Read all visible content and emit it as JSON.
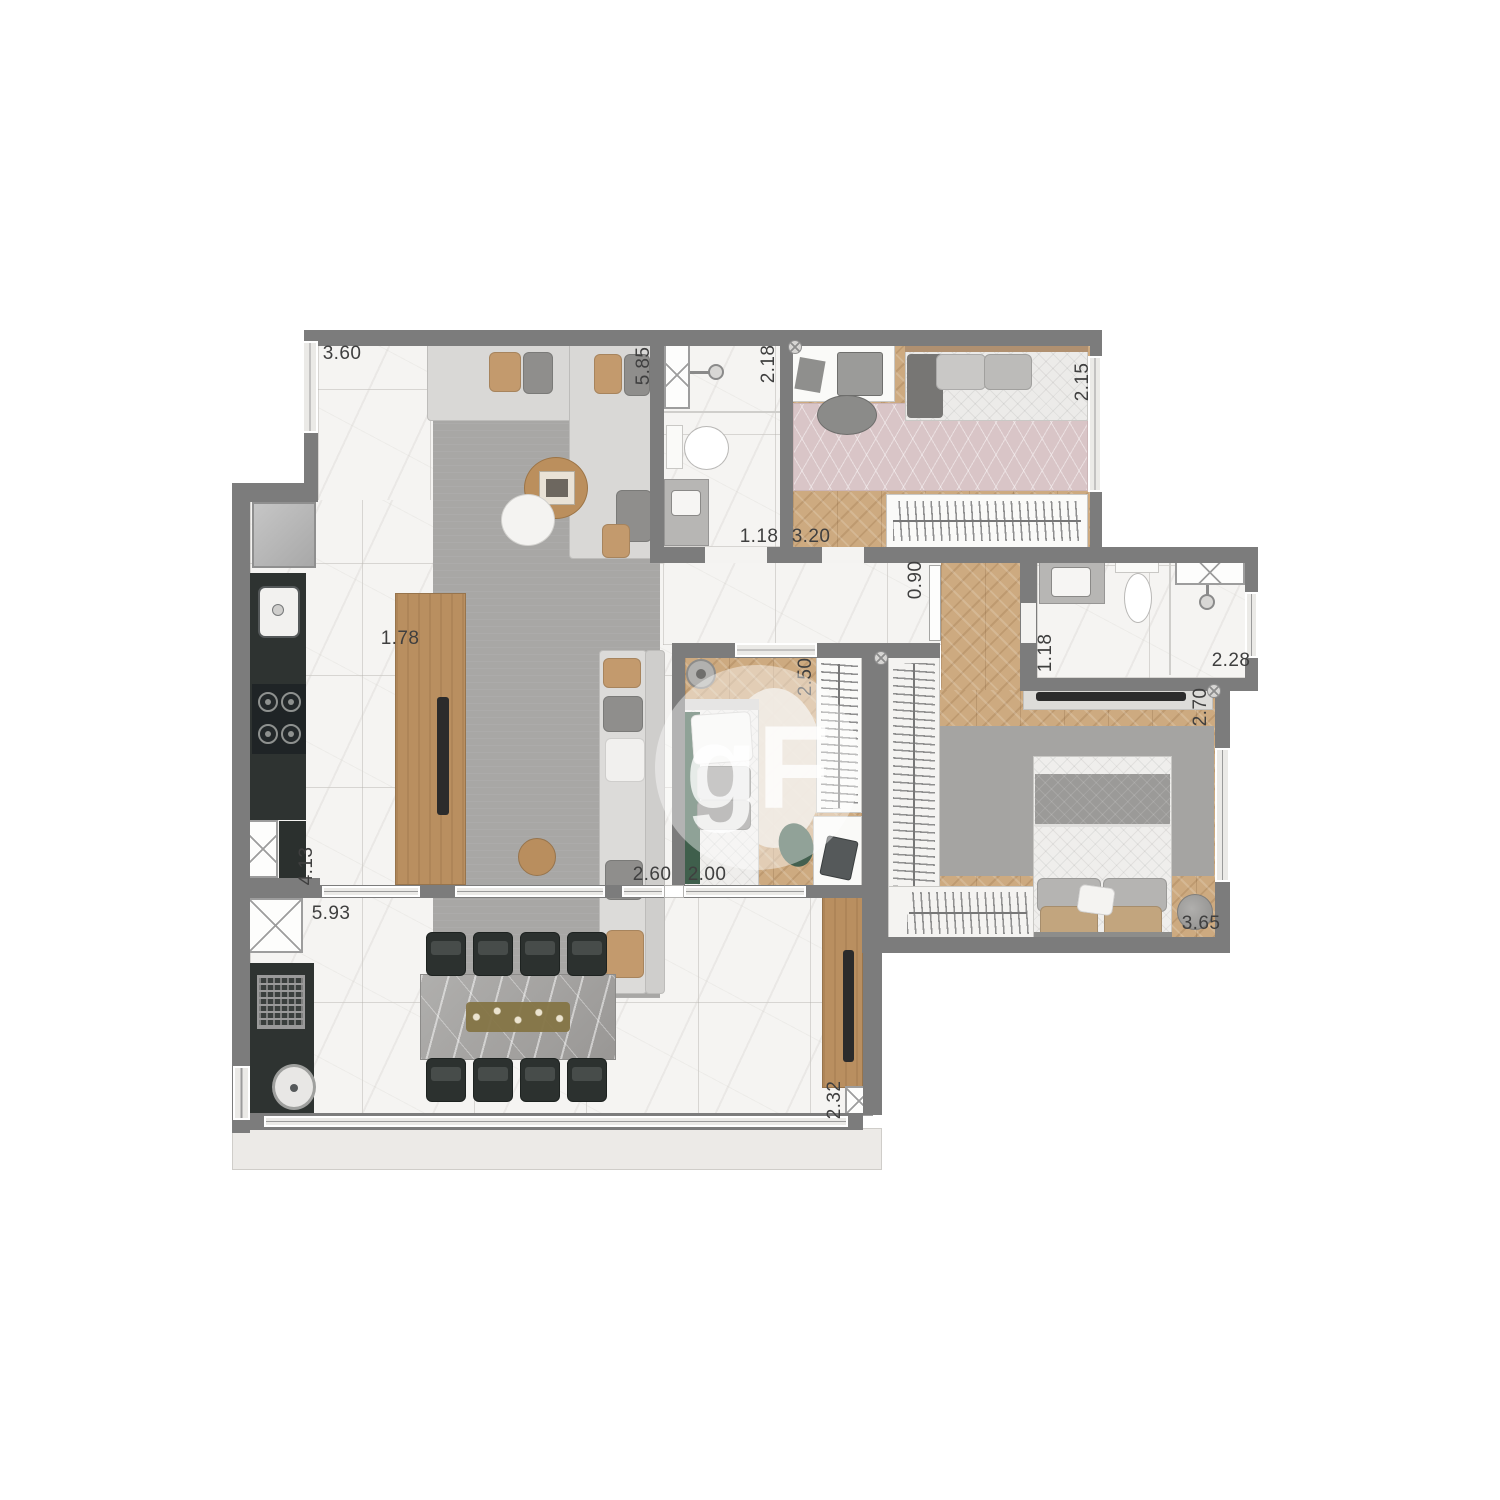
{
  "plan_title": "apartment-floor-plan",
  "watermark": {
    "text": "gF"
  },
  "colors": {
    "wall": "#7c7c7c",
    "marble": "#f5f4f2",
    "wood": "#cdaa80",
    "panel": "#b98f60",
    "counter": "#2e3331",
    "ruggray": "#a8a7a5",
    "rugpink": "#d9c5c7",
    "green": "#3f5f4c",
    "slab": "#eceae7",
    "dimtext": "#3f3f3f"
  },
  "dimensions": [
    {
      "text": "3.60",
      "x": 342,
      "y": 354,
      "vertical": false
    },
    {
      "text": "5.85",
      "x": 644,
      "y": 366,
      "vertical": true
    },
    {
      "text": "2.18",
      "x": 769,
      "y": 364,
      "vertical": true
    },
    {
      "text": "2.15",
      "x": 1083,
      "y": 382,
      "vertical": true
    },
    {
      "text": "1.18",
      "x": 759,
      "y": 537,
      "vertical": false
    },
    {
      "text": "3.20",
      "x": 811,
      "y": 537,
      "vertical": false
    },
    {
      "text": "0.90",
      "x": 916,
      "y": 580,
      "vertical": true
    },
    {
      "text": "1.78",
      "x": 400,
      "y": 639,
      "vertical": false
    },
    {
      "text": "2.50",
      "x": 806,
      "y": 677,
      "vertical": true
    },
    {
      "text": "1.18",
      "x": 1046,
      "y": 653,
      "vertical": true
    },
    {
      "text": "2.28",
      "x": 1231,
      "y": 661,
      "vertical": false
    },
    {
      "text": "2.70",
      "x": 1201,
      "y": 707,
      "vertical": true
    },
    {
      "text": "2.60",
      "x": 652,
      "y": 875,
      "vertical": false
    },
    {
      "text": "2.00",
      "x": 707,
      "y": 875,
      "vertical": false
    },
    {
      "text": "4.13",
      "x": 307,
      "y": 866,
      "vertical": true
    },
    {
      "text": "5.93",
      "x": 331,
      "y": 914,
      "vertical": false
    },
    {
      "text": "3.65",
      "x": 1201,
      "y": 924,
      "vertical": false
    },
    {
      "text": "2.32",
      "x": 835,
      "y": 1100,
      "vertical": true
    }
  ],
  "symbols": [
    {
      "name": "sprinkler-symbol",
      "x": 795,
      "y": 347
    },
    {
      "name": "sprinkler-symbol",
      "x": 881,
      "y": 658
    },
    {
      "name": "sprinkler-symbol",
      "x": 1214,
      "y": 691
    }
  ]
}
